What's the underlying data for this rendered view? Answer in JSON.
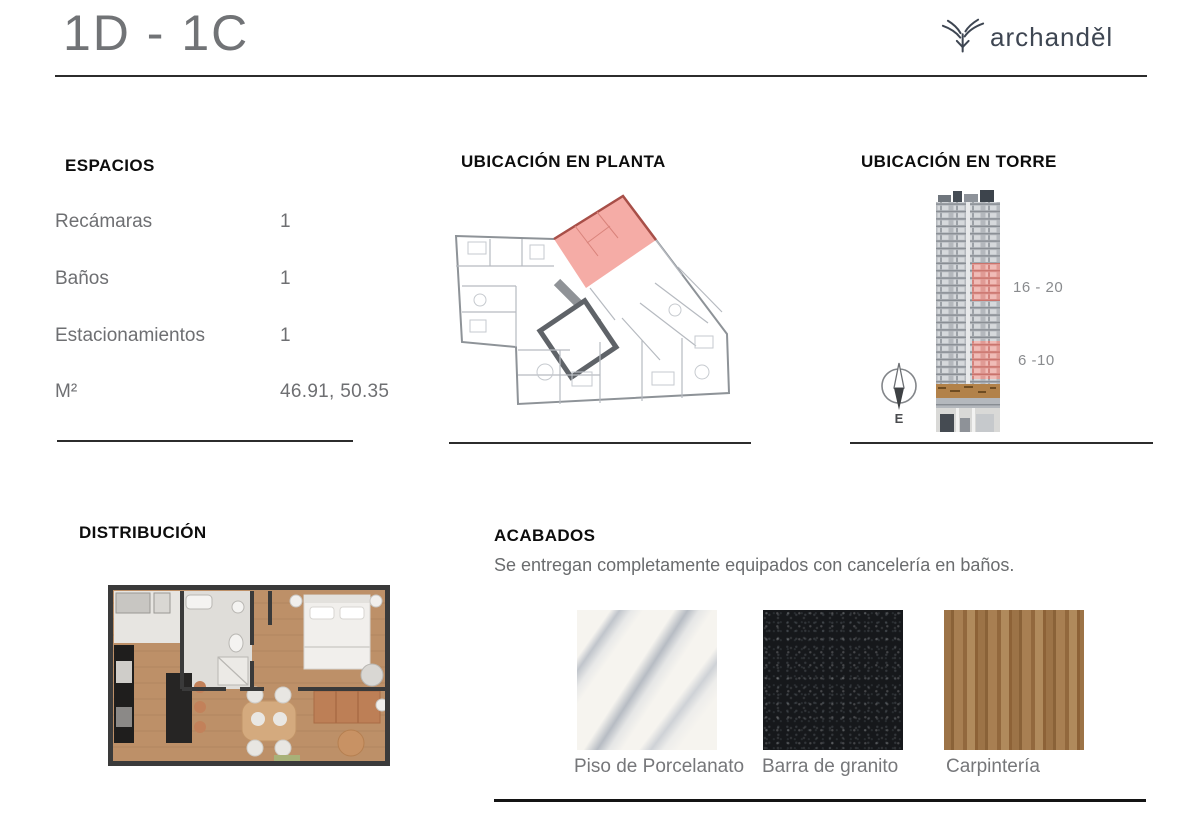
{
  "header": {
    "title": "1D - 1C",
    "brand": "archanděl"
  },
  "espacios": {
    "heading": "ESPACIOS",
    "rows": [
      {
        "label": "Recámaras",
        "value": "1"
      },
      {
        "label": "Baños",
        "value": "1"
      },
      {
        "label": "Estacionamientos",
        "value": "1"
      },
      {
        "label": "M²",
        "value": "46.91, 50.35"
      }
    ]
  },
  "planta": {
    "heading": "UBICACIÓN EN PLANTA",
    "highlight_color": "#f4a8a1"
  },
  "torre": {
    "heading": "UBICACIÓN EN TORRE",
    "floor_range_upper": "16 - 20",
    "floor_range_lower": "6 -10",
    "compass_direction": "E",
    "highlight_color": "#e09b95"
  },
  "distribucion": {
    "heading": "DISTRIBUCIÓN"
  },
  "acabados": {
    "heading": "ACABADOS",
    "subtitle": "Se entregan completamente equipados con cancelería en baños.",
    "materials": [
      {
        "name": "Piso de Porcelanato"
      },
      {
        "name": "Barra de granito"
      },
      {
        "name": "Carpintería"
      }
    ]
  },
  "colors": {
    "text_gray": "#6e6f72",
    "heading_black": "#0d0d0d",
    "brand_navy": "#3e4652",
    "unit_highlight": "#f4a8a1",
    "tower_highlight": "#e09b95"
  }
}
